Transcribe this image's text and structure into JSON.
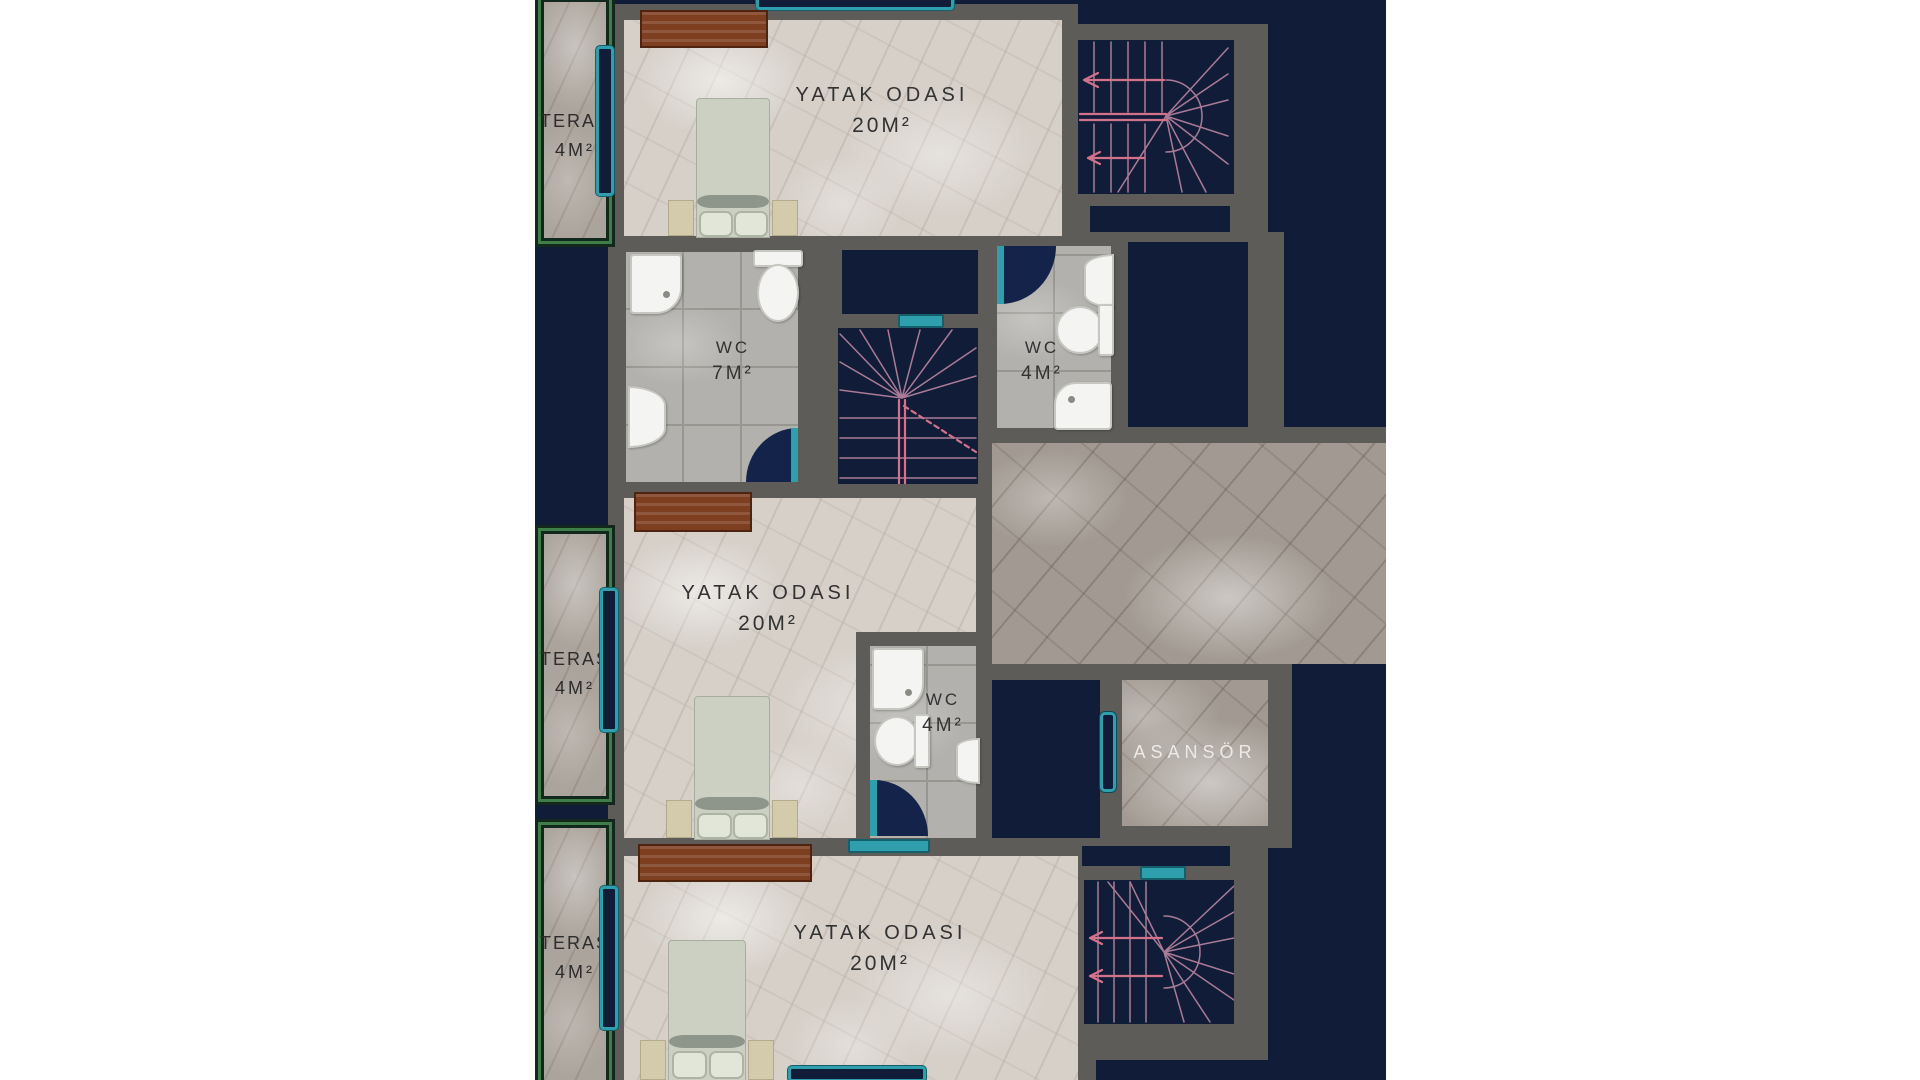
{
  "palette": {
    "page_background": "#ffffff",
    "site_navy": "#101c38",
    "wall_gray": "#5e5c59",
    "accent_teal": "#2f9fae",
    "stair_pink": "#d4728b",
    "teras_green": "#3f7d49",
    "wardrobe_brown": "#7e3e20"
  },
  "rooms": {
    "bedroom_top": {
      "name": "YATAK ODASI",
      "area": "20M²"
    },
    "bedroom_middle": {
      "name": "YATAK ODASI",
      "area": "20M²"
    },
    "bedroom_bottom": {
      "name": "YATAK ODASI",
      "area": "20M²"
    },
    "wc_large": {
      "name": "WC",
      "area": "7M²"
    },
    "wc_right": {
      "name": "WC",
      "area": "4M²"
    },
    "wc_middle": {
      "name": "WC",
      "area": "4M²"
    },
    "teras_top": {
      "name": "TERAS",
      "area": "4M²"
    },
    "teras_middle": {
      "name": "TERAS",
      "area": "4M²"
    },
    "teras_bottom": {
      "name": "TERAS",
      "area": "4M²"
    },
    "elevator": {
      "name": "ASANSÖR"
    }
  }
}
